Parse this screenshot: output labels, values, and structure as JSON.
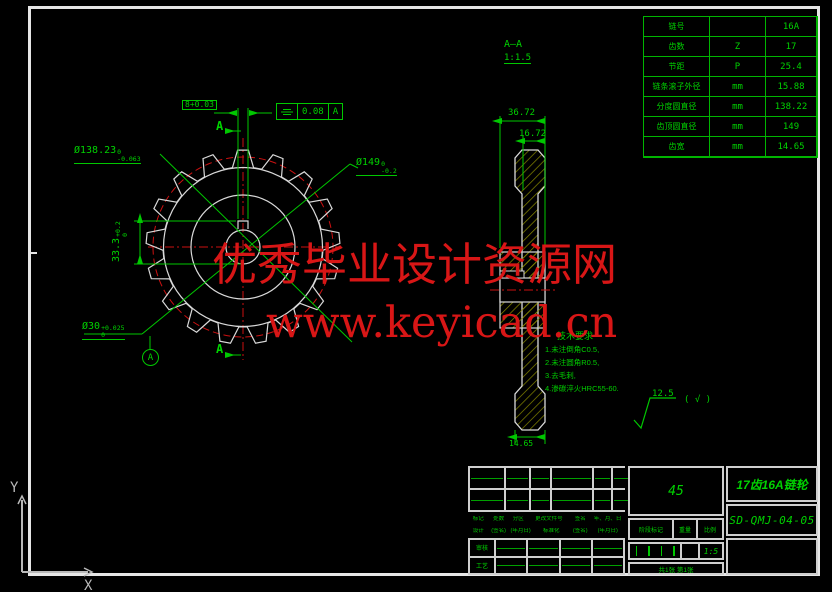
{
  "colors": {
    "cad_green": "#00c800",
    "cad_red": "#cc1111",
    "geometry_white": "#d9d9d9",
    "hatch_olive": "#8a8a00",
    "watermark_red": "#d81616"
  },
  "watermark": {
    "line1": "优秀毕业设计资源网",
    "line2": "www.keyicad.cn"
  },
  "param_table": {
    "rows": [
      {
        "label": "链号",
        "symbol": "",
        "value": "16A"
      },
      {
        "label": "齿数",
        "symbol": "Z",
        "value": "17"
      },
      {
        "label": "节距",
        "symbol": "P",
        "value": "25.4"
      },
      {
        "label": "链条滚子外径",
        "symbol": "mm",
        "value": "15.88"
      },
      {
        "label": "分度圆直径",
        "symbol": "mm",
        "value": "138.22"
      },
      {
        "label": "齿顶圆直径",
        "symbol": "mm",
        "value": "149"
      },
      {
        "label": "齿宽",
        "symbol": "mm",
        "value": "14.65"
      }
    ]
  },
  "front_view": {
    "keyway_dim": "8+0.03",
    "tol_value": "0.08",
    "tol_datum": "A",
    "pitch_dia": {
      "base": "Ø138.23",
      "sup": "0",
      "sub": "-0.063"
    },
    "tip_dia": {
      "base": "Ø149",
      "sup": "0",
      "sub": "-0.2"
    },
    "bore_dia": {
      "base": "Ø30",
      "sup": "+0.025",
      "sub": "0"
    },
    "keyway_depth": {
      "base": "33.3",
      "sup": "+0.2",
      "sub": "0"
    },
    "datum": "A",
    "section_mark": "A"
  },
  "section_view": {
    "label": "A—A",
    "scale": "1:1.5",
    "width_total": "36.72",
    "width_rim": "16.72",
    "tooth_width": "14.65"
  },
  "notes": {
    "title": "技术要求",
    "items": [
      "1.未注倒角C0.5,",
      "2.未注圆角R0.5,",
      "3.去毛刺,",
      "4.渗碳淬火HRC55-60."
    ]
  },
  "roughness": {
    "value": "12.5",
    "other": "( √ )"
  },
  "title_block": {
    "material": "45",
    "part_name": "17齿16A链轮",
    "drawing_no": "SD-QMJ-04-05",
    "scale": "1:5",
    "sheet": "共1张 第1张",
    "row1": [
      "标记",
      "处数",
      "分区",
      "更改文件号",
      "签名",
      "年、月、日"
    ],
    "row2": [
      "设计",
      "(签名)",
      "(年月日)",
      "标准化",
      "(签名)",
      "(年月日)"
    ],
    "stage": [
      "阶段标记",
      "重量",
      "比例"
    ],
    "left_labels": [
      "审核",
      "工艺"
    ]
  },
  "ucs": {
    "x": "X",
    "y": "Y"
  }
}
